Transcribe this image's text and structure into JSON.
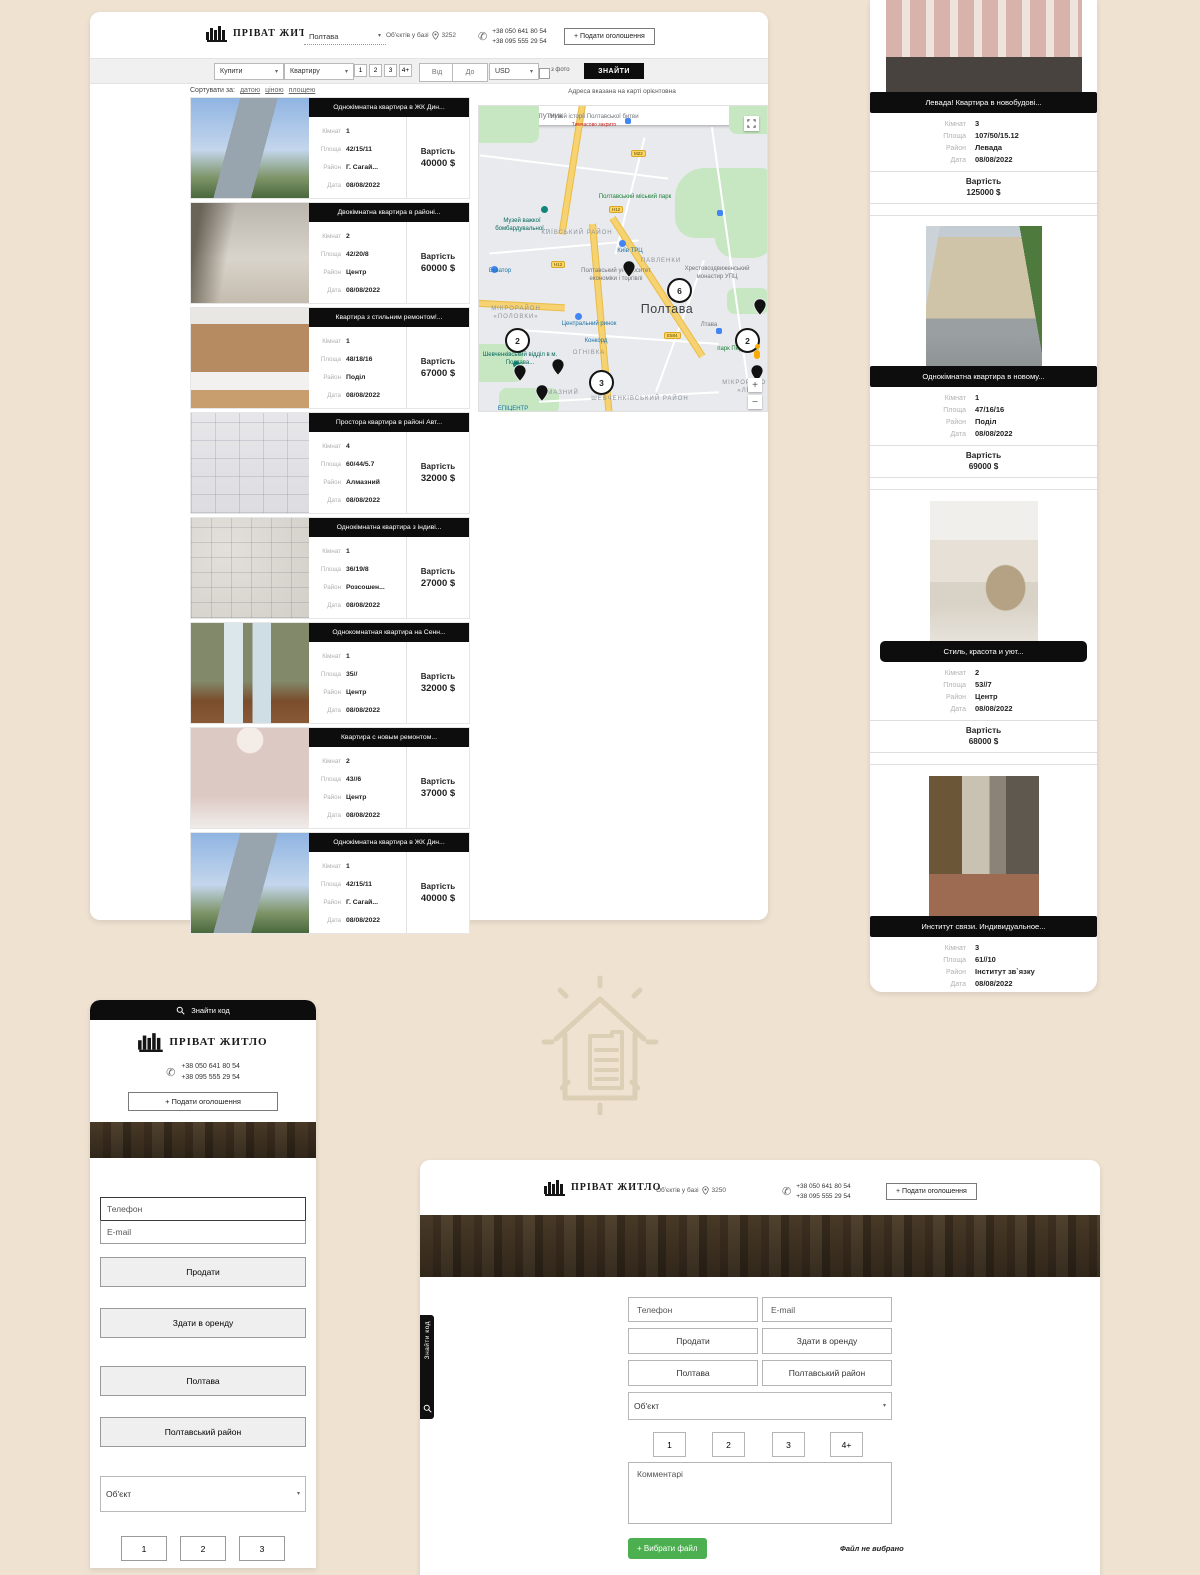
{
  "brand": {
    "name": "ПРІВАТ ЖИТЛО"
  },
  "labels": {
    "rooms": "Кімнат",
    "area": "Площа",
    "district": "Район",
    "date": "Дата",
    "price": "Вартість"
  },
  "desktop": {
    "header": {
      "city": "Полтава",
      "objects_label": "Об'єктів у базі",
      "objects_count": "3252",
      "phone1": "+38 050 641 80 54",
      "phone2": "+38 095 555 29 54",
      "post_ad": "+ Подати оголошення"
    },
    "search": {
      "deal": "Купити",
      "estate": "Квартиру",
      "rooms": [
        "1",
        "2",
        "3",
        "4+"
      ],
      "price_from": "Від",
      "price_to": "До",
      "currency": "USD",
      "with_photo": "з фото",
      "submit": "ЗНАЙТИ"
    },
    "sort": {
      "label": "Сортувати за:",
      "by_date": "датою",
      "by_price": "ціною",
      "by_area": "площею"
    },
    "map": {
      "tabs": [
        "Карта",
        "Супутник"
      ],
      "note": "Адреса вказана на карті орієнтовна",
      "clusters": [
        "6",
        "2",
        "2",
        "3"
      ],
      "zoom_in": "+",
      "zoom_out": "−",
      "labels": {
        "museum_battle": "Музей історії Полтавської битви",
        "closed": "Тимчасово закрито",
        "city_park": "Полтавський міський парк",
        "museum_aviation": "Музей важкої бомбардувальної...",
        "kyiv_district": "КИЇВСЬКИЙ РАЙОН",
        "kyiv_mall": "Київ ТРЦ",
        "pavlenky": "ПАВЛЕНКИ",
        "university": "Полтавський університет економіки і торгівлі",
        "monastery": "Хрестовоздвиженський монастир УПЦ",
        "city": "Полтава",
        "polovky": "МІКРОРАЙОН «ПОЛОВКИ»",
        "police": "Шевченківський відділ в м. Полтава...",
        "ohnivka": "ОГНІВКА",
        "market": "Центральний ринок",
        "concord": "Конкорд",
        "almazny": "АЛМАЗНИЙ",
        "shevchenkivsky": "ШЕВЧЕНКІВСЬКИЙ РАЙОН",
        "lev": "МІКРОРАЙОН «ЛЕВ",
        "victory_park": "парк Перемоги",
        "ltava": "Лтава",
        "ekvator": "Екватор",
        "epicentr": "ЕПІЦЕНТР",
        "road_m22": "М22",
        "road_h12": "Н12",
        "road_e584": "Е584"
      }
    },
    "listings": [
      {
        "title": "Однокімнатна квартира в ЖК Дин...",
        "rooms": "1",
        "area": "42/15/11",
        "district": "Г. Сагай...",
        "date": "08/08/2022",
        "price": "40000 $"
      },
      {
        "title": "Двокімнатна квартира в районі...",
        "rooms": "2",
        "area": "42/20/8",
        "district": "Центр",
        "date": "08/08/2022",
        "price": "60000 $"
      },
      {
        "title": "Квартира з стильним ремонтом!...",
        "rooms": "1",
        "area": "48/18/16",
        "district": "Поділ",
        "date": "08/08/2022",
        "price": "67000 $"
      },
      {
        "title": "Простора квартира в районі Авт...",
        "rooms": "4",
        "area": "60/44/5.7",
        "district": "Алмазний",
        "date": "08/08/2022",
        "price": "32000 $"
      },
      {
        "title": "Однокімнатна квартира з індиві...",
        "rooms": "1",
        "area": "36/19/8",
        "district": "Розсошен...",
        "date": "08/08/2022",
        "price": "27000 $"
      },
      {
        "title": "Однокомнатная квартира на Сенн...",
        "rooms": "1",
        "area": "35//",
        "district": "Центр",
        "date": "08/08/2022",
        "price": "32000 $"
      },
      {
        "title": "Квартира с новым ремонтом...",
        "rooms": "2",
        "area": "43//6",
        "district": "Центр",
        "date": "08/08/2022",
        "price": "37000 $"
      },
      {
        "title": "Однокімнатна квартира в ЖК Дин...",
        "rooms": "1",
        "area": "42/15/11",
        "district": "Г. Сагай...",
        "date": "08/08/2022",
        "price": "40000 $"
      }
    ]
  },
  "right_list": {
    "listings": [
      {
        "title": "Левада! Квартира в новобудові...",
        "rooms": "3",
        "area": "107/50/15.12",
        "district": "Левада",
        "date": "08/08/2022",
        "price": "125000 $"
      },
      {
        "title": "Однокімнатна квартира в новому...",
        "rooms": "1",
        "area": "47/16/16",
        "district": "Поділ",
        "date": "08/08/2022",
        "price": "69000 $"
      },
      {
        "title": "Стиль, красота и уют...",
        "rooms": "2",
        "area": "53//7",
        "district": "Центр",
        "date": "08/08/2022",
        "price": "68000 $"
      },
      {
        "title": "Институт связи. Индивидуальное...",
        "rooms": "3",
        "area": "61//10",
        "district": "Інститут зв`язку",
        "date": "08/08/2022",
        "price": "48000 $"
      }
    ]
  },
  "mobile": {
    "find_code": "Знайти код",
    "phone1": "+38 050 641 80 54",
    "phone2": "+38 095 555 29 54",
    "post_ad": "+ Подати оголошення",
    "form": {
      "phone": "Телефон",
      "email": "E-mail",
      "sell": "Продати",
      "rent": "Здати в оренду",
      "city": "Полтава",
      "district": "Полтавський район",
      "object": "Об'єкт",
      "rooms": [
        "1",
        "2",
        "3"
      ]
    }
  },
  "tablet": {
    "header": {
      "objects_label": "Об'єктів у базі",
      "objects_count": "3250",
      "phone1": "+38 050 641 80 54",
      "phone2": "+38 095 555 29 54",
      "post_ad": "+ Подати оголошення"
    },
    "side_tab": "Знайти код",
    "form": {
      "phone": "Телефон",
      "email": "E-mail",
      "sell": "Продати",
      "rent": "Здати в оренду",
      "city": "Полтава",
      "district": "Полтавський район",
      "object": "Об'єкт",
      "rooms": [
        "1",
        "2",
        "3",
        "4+"
      ],
      "comments": "Комментарі",
      "choose_file": "+ Вибрати файл",
      "no_file": "Файл не вибрано"
    }
  }
}
